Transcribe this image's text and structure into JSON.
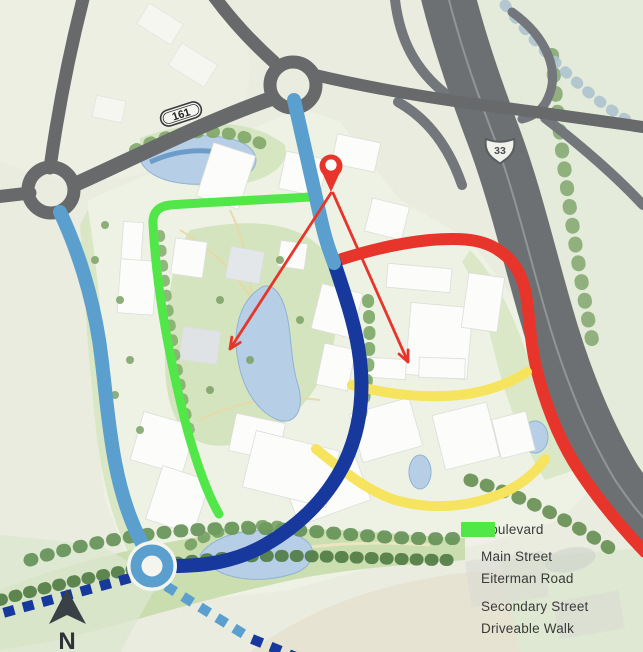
{
  "legend": {
    "items": [
      {
        "label": "Boulevard",
        "color": "#5b9fcf"
      },
      {
        "label": "Main Street",
        "color": "#17399e"
      },
      {
        "label": "Eiterman Road",
        "color": "#9c2a24"
      },
      {
        "label": "Secondary Street",
        "color": "#f6e35e"
      },
      {
        "label": "Driveable Walk",
        "color": "#52e748"
      }
    ]
  },
  "map": {
    "shields": {
      "route_161": "161",
      "route_33": "33"
    },
    "compass_label": "N"
  },
  "colors": {
    "boulevard": "#5b9fcf",
    "main_street": "#17399e",
    "eiterman_road": "#e8352b",
    "secondary_street": "#f6e35e",
    "driveable_walk": "#52e748",
    "annotation_red": "#e8352b",
    "road_gray": "#67696b",
    "highway_gray": "#6d7072",
    "water": "#b7cfe6"
  }
}
